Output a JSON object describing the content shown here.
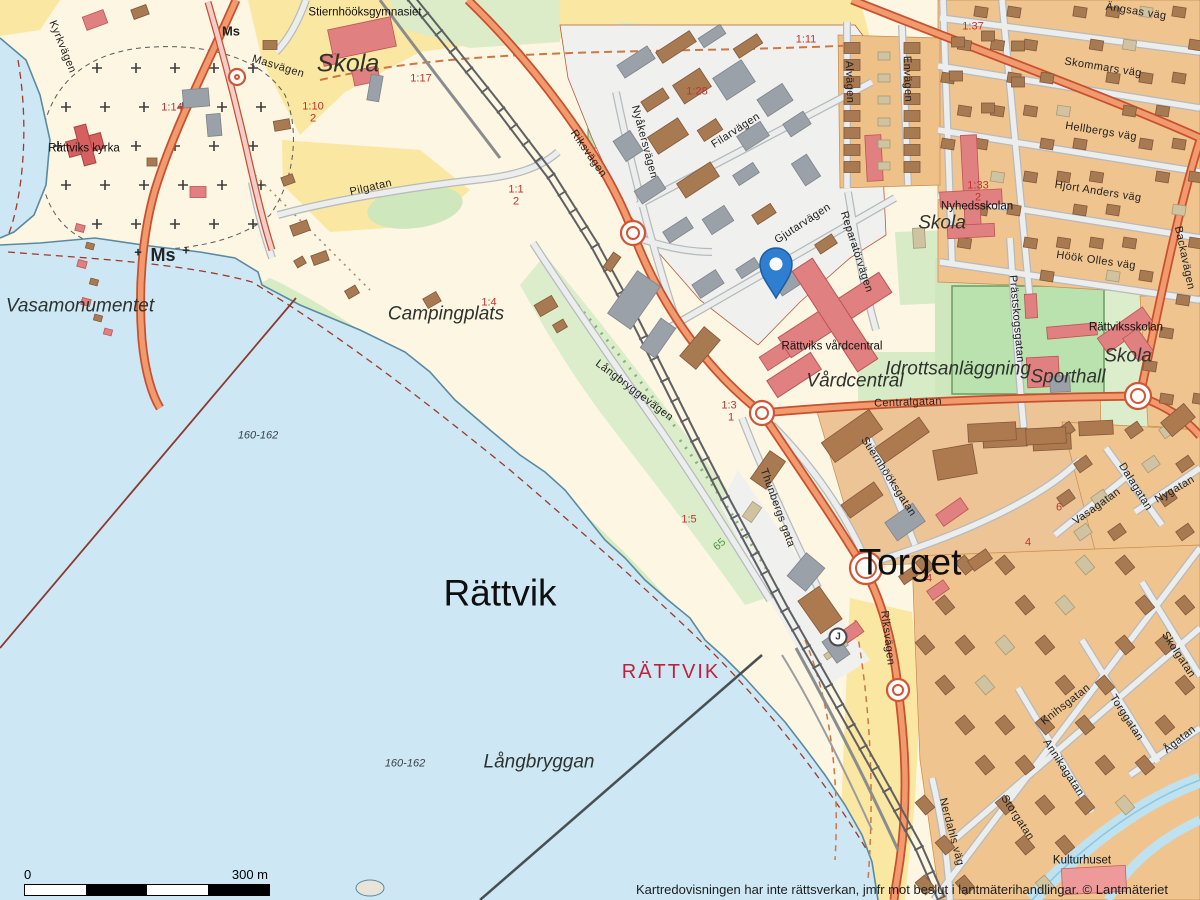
{
  "map_name": "Rättvik map",
  "scalebar": {
    "start": "0",
    "end": "300 m"
  },
  "disclaimer": "Kartredovisningen har inte rättsverkan, jmfr mot beslut i lantmäterihandlingar. © Lantmäteriet",
  "pin": {
    "x": 776,
    "y": 297,
    "color": "#2e7ed2"
  },
  "station_marker": {
    "t": "J",
    "x": 838,
    "y": 637
  },
  "colors": {
    "water": "#cde8f4",
    "land": "#fcf6e2",
    "field_yellow": "#fae7a1",
    "green": "#d5ebc5",
    "sport_green": "#b9e2ae",
    "industrial": "#f0f1ef",
    "residential": "#f0c48e",
    "road_main_fill": "#f09a6e",
    "road_main_case": "#c8502f",
    "road_minor_fill": "#eceeee",
    "building_brown": "#a87a52",
    "building_gray": "#9ba1a8",
    "building_public_red": "#e08080",
    "pin_blue": "#2e7ed2",
    "city_red_text": "#c2203a"
  },
  "labels": [
    {
      "t": "Stiernhööksgymnasiet",
      "x": 365,
      "y": 13,
      "r": 0,
      "c": "place",
      "n": "label-stiernhooksgymnasiet"
    },
    {
      "t": "Skola",
      "x": 348,
      "y": 64,
      "r": 0,
      "c": "area-lg",
      "n": "label-skola-west"
    },
    {
      "t": "Ms",
      "x": 231,
      "y": 31,
      "r": 0,
      "c": "ms",
      "n": "label-ms-north"
    },
    {
      "t": "Masvägen",
      "x": 278,
      "y": 67,
      "r": 17,
      "c": "street",
      "n": "label-masvagen"
    },
    {
      "t": "Kyrkvägen",
      "x": 62,
      "y": 47,
      "r": 68,
      "c": "street",
      "n": "label-kyrkvagen"
    },
    {
      "t": "Rättviks kyrka",
      "x": 84,
      "y": 149,
      "r": 0,
      "c": "place",
      "n": "label-rattviks-kyrka"
    },
    {
      "t": "1:14",
      "x": 172,
      "y": 108,
      "r": 0,
      "c": "parcel"
    },
    {
      "t": "1:17",
      "x": 421,
      "y": 79,
      "r": 0,
      "c": "parcel"
    },
    {
      "t": "1:10",
      "x": 313,
      "y": 107,
      "r": 0,
      "c": "parcel"
    },
    {
      "t": "2",
      "x": 313,
      "y": 119,
      "r": 0,
      "c": "parcel"
    },
    {
      "t": "1:1",
      "x": 516,
      "y": 190,
      "r": 0,
      "c": "parcel"
    },
    {
      "t": "2",
      "x": 516,
      "y": 202,
      "r": 0,
      "c": "parcel"
    },
    {
      "t": "Pilgatan",
      "x": 371,
      "y": 188,
      "r": -13,
      "c": "street",
      "n": "label-pilgatan"
    },
    {
      "t": "Riksvägen",
      "x": 588,
      "y": 154,
      "r": 55,
      "c": "street",
      "n": "label-riksvagen-north"
    },
    {
      "t": "Nyåkersvägen",
      "x": 644,
      "y": 142,
      "r": 75,
      "c": "street",
      "n": "label-nyakersvagen"
    },
    {
      "t": "Filarvägen",
      "x": 736,
      "y": 131,
      "r": -33,
      "c": "street",
      "n": "label-filarvagen"
    },
    {
      "t": "1:28",
      "x": 697,
      "y": 92,
      "r": 0,
      "c": "parcel"
    },
    {
      "t": "1:11",
      "x": 806,
      "y": 40,
      "r": 0,
      "c": "parcel"
    },
    {
      "t": "Gjutarvägen",
      "x": 803,
      "y": 224,
      "r": -33,
      "c": "street",
      "n": "label-gjutarvagen"
    },
    {
      "t": "Reparatörvägen",
      "x": 856,
      "y": 252,
      "r": 72,
      "c": "street",
      "n": "label-reparatorvagen"
    },
    {
      "t": "Alvägen",
      "x": 849,
      "y": 82,
      "r": 88,
      "c": "street",
      "n": "label-alvagen"
    },
    {
      "t": "Envägen",
      "x": 907,
      "y": 79,
      "r": 88,
      "c": "street",
      "n": "label-envagen"
    },
    {
      "t": "1:37",
      "x": 973,
      "y": 27,
      "r": 0,
      "c": "parcel"
    },
    {
      "t": "Ängsas väg",
      "x": 1136,
      "y": 12,
      "r": 9,
      "c": "street",
      "n": "label-angsas-vag"
    },
    {
      "t": "Skommars väg",
      "x": 1103,
      "y": 68,
      "r": 9,
      "c": "street",
      "n": "label-skommars-vag"
    },
    {
      "t": "Hellbergs väg",
      "x": 1101,
      "y": 132,
      "r": 9,
      "c": "street",
      "n": "label-hellbergs-vag"
    },
    {
      "t": "Hjort Anders väg",
      "x": 1098,
      "y": 192,
      "r": 9,
      "c": "street",
      "n": "label-hjort-anders-vag"
    },
    {
      "t": "Höök Olles väg",
      "x": 1096,
      "y": 261,
      "r": 8,
      "c": "street",
      "n": "label-hook-olles-vag"
    },
    {
      "t": "Backavägen",
      "x": 1184,
      "y": 258,
      "r": 78,
      "c": "street",
      "n": "label-backavagen"
    },
    {
      "t": "1:33",
      "x": 978,
      "y": 186,
      "r": 0,
      "c": "parcel"
    },
    {
      "t": "2",
      "x": 978,
      "y": 198,
      "r": 0,
      "c": "parcel"
    },
    {
      "t": "Nyhedsskolan",
      "x": 977,
      "y": 207,
      "r": 0,
      "c": "place",
      "n": "label-nyhedsskolan"
    },
    {
      "t": "Skola",
      "x": 942,
      "y": 223,
      "r": 0,
      "c": "area",
      "n": "label-skola-nyhed"
    },
    {
      "t": "Rättviksskolan",
      "x": 1126,
      "y": 328,
      "r": 0,
      "c": "place",
      "n": "label-rattviksskolan"
    },
    {
      "t": "Skola",
      "x": 1128,
      "y": 356,
      "r": 0,
      "c": "area",
      "n": "label-skola-east"
    },
    {
      "t": "Prästskogsgatan",
      "x": 1016,
      "y": 319,
      "r": 85,
      "c": "street",
      "n": "label-prastskogsgatan"
    },
    {
      "t": "Idrottsanläggning",
      "x": 958,
      "y": 369,
      "r": 0,
      "c": "area",
      "n": "label-idrottsanlaggning"
    },
    {
      "t": "Sporthall",
      "x": 1068,
      "y": 377,
      "r": 0,
      "c": "area",
      "n": "label-sporthall"
    },
    {
      "t": "Rättviks vårdcentral",
      "x": 832,
      "y": 347,
      "r": 0,
      "c": "place",
      "n": "label-rattviks-vardcentral"
    },
    {
      "t": "Vårdcentral",
      "x": 855,
      "y": 381,
      "r": 0,
      "c": "area",
      "n": "label-vardcentral"
    },
    {
      "t": "Centralgatan",
      "x": 908,
      "y": 403,
      "r": -2,
      "c": "street",
      "n": "label-centralgatan"
    },
    {
      "t": "1:3",
      "x": 729,
      "y": 406,
      "r": 0,
      "c": "parcel"
    },
    {
      "t": "1",
      "x": 731,
      "y": 418,
      "r": 0,
      "c": "parcel"
    },
    {
      "t": "Stiernhööksgatan",
      "x": 888,
      "y": 477,
      "r": 57,
      "c": "street",
      "n": "label-stiernhooksgatan"
    },
    {
      "t": "Torget",
      "x": 910,
      "y": 562,
      "r": 0,
      "c": "city",
      "n": "label-torget"
    },
    {
      "t": "6",
      "x": 1059,
      "y": 508,
      "r": 0,
      "c": "parcel"
    },
    {
      "t": "4",
      "x": 1028,
      "y": 543,
      "r": 0,
      "c": "parcel"
    },
    {
      "t": "4",
      "x": 929,
      "y": 579,
      "r": 0,
      "c": "parcel"
    },
    {
      "t": "Thunbergs gata",
      "x": 777,
      "y": 508,
      "r": 70,
      "c": "street",
      "n": "label-thunbergs-gata"
    },
    {
      "t": "Riksvägen",
      "x": 887,
      "y": 638,
      "r": 83,
      "c": "street",
      "n": "label-riksvagen-south"
    },
    {
      "t": "Långbryggevägen",
      "x": 634,
      "y": 391,
      "r": 37,
      "c": "street",
      "n": "label-langbryggevagen"
    },
    {
      "t": "Campingplats",
      "x": 446,
      "y": 314,
      "r": 0,
      "c": "area",
      "n": "label-campingplats"
    },
    {
      "t": "1:4",
      "x": 489,
      "y": 303,
      "r": 0,
      "c": "parcel"
    },
    {
      "t": "1:5",
      "x": 689,
      "y": 520,
      "r": 0,
      "c": "parcel"
    },
    {
      "t": "65",
      "x": 720,
      "y": 545,
      "r": -40,
      "c": "green-num"
    },
    {
      "t": "Vasamonumentet",
      "x": 80,
      "y": 306,
      "r": 0,
      "c": "area",
      "n": "label-vasamonumentet"
    },
    {
      "t": "Ms",
      "x": 163,
      "y": 255,
      "r": 0,
      "c": "ms-lg",
      "n": "label-ms-point"
    },
    {
      "t": "+",
      "x": 138,
      "y": 252,
      "r": 0,
      "c": "ms"
    },
    {
      "t": "+",
      "x": 186,
      "y": 250,
      "r": 0,
      "c": "ms"
    },
    {
      "t": "160-162",
      "x": 258,
      "y": 436,
      "r": 0,
      "c": "area-sm"
    },
    {
      "t": "Rättvik",
      "x": 500,
      "y": 593,
      "r": 0,
      "c": "city",
      "n": "label-rattvik-city"
    },
    {
      "t": "RÄTTVIK",
      "x": 671,
      "y": 672,
      "r": 0,
      "c": "city-red",
      "n": "label-rattvik-red"
    },
    {
      "t": "160-162",
      "x": 405,
      "y": 764,
      "r": 0,
      "c": "area-sm"
    },
    {
      "t": "Långbryggan",
      "x": 539,
      "y": 762,
      "r": 0,
      "c": "area",
      "n": "label-langbryggan"
    },
    {
      "t": "Knihsgatan",
      "x": 1066,
      "y": 705,
      "r": -38,
      "c": "street",
      "n": "label-knihsgatan"
    },
    {
      "t": "Annikagatan",
      "x": 1063,
      "y": 768,
      "r": 57,
      "c": "street",
      "n": "label-annikagatan"
    },
    {
      "t": "Torggatan",
      "x": 1126,
      "y": 718,
      "r": 57,
      "c": "street",
      "n": "label-torggatan"
    },
    {
      "t": "Skolgatan",
      "x": 1178,
      "y": 655,
      "r": 57,
      "c": "street",
      "n": "label-skolgatan"
    },
    {
      "t": "Ågatan",
      "x": 1180,
      "y": 740,
      "r": -38,
      "c": "street",
      "n": "label-agatan"
    },
    {
      "t": "Storgatan",
      "x": 1017,
      "y": 818,
      "r": 57,
      "c": "street",
      "n": "label-storgatan"
    },
    {
      "t": "Nerdahls väg",
      "x": 951,
      "y": 832,
      "r": 75,
      "c": "street",
      "n": "label-nerdahls-vag"
    },
    {
      "t": "Vasagatan",
      "x": 1097,
      "y": 507,
      "r": -35,
      "c": "street",
      "n": "label-vasagatan"
    },
    {
      "t": "Dalagatan",
      "x": 1135,
      "y": 487,
      "r": 58,
      "c": "street",
      "n": "label-dalagatan"
    },
    {
      "t": "Nygatan",
      "x": 1175,
      "y": 490,
      "r": -30,
      "c": "street",
      "n": "label-nygatan"
    },
    {
      "t": "Kulturhuset",
      "x": 1082,
      "y": 861,
      "r": 0,
      "c": "place",
      "n": "label-kulturhuset"
    }
  ]
}
